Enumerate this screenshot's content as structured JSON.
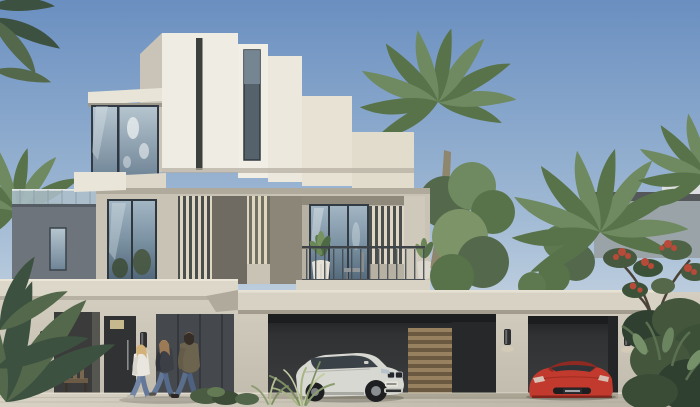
{
  "meta": {
    "domain": "architectural-exterior-render",
    "description": "Daytime render of a three-storey contemporary cream villa built of stacked cubic volumes with corner glass windows, timber louvre screens and a wide two-bay carport. A white luxury SUV and a red sports coupe sit in the carport, three residents stroll along the front pavement, and date palms with tropical planting frame the scene under a clear blue sky.",
    "time_of_day": "day",
    "weather": "clear"
  },
  "palette": {
    "sky_top": "#6a8fc0",
    "sky_mid": "#9db7d3",
    "sky_horizon": "#cdd9e4",
    "sky_base": "#d8dee3",
    "wall_white": "#efece3",
    "wall_white_shade": "#c9c4b7",
    "wall_cream": "#e2dccd",
    "wall_beige": "#cfc9bb",
    "wall_second_floor": "#c9c3b5",
    "wall_dark_wing": "#6e747b",
    "fascia": "#ddd7c9",
    "fascia_garage": "#d8d2c4",
    "soffit_shadow": "#a59f92",
    "glass_light": "#a3b6c4",
    "glass_dark": "#4e6476",
    "frame_dark": "#323b43",
    "opening_dark": "#303234",
    "passage_gray": "#45484c",
    "louver_cream": "#ded6c2",
    "louver_back": "#4a4e4c",
    "wood_light": "#97815e",
    "wood_dark": "#6b5840",
    "pavement_light": "#d8d2c4",
    "pavement_dark": "#b7b1a4",
    "trunk": "#8f866e",
    "palm_green": "#6f8a60",
    "palm_green_dark": "#587349",
    "foliage_dark": "#3c5038",
    "foliage_mid": "#53694b",
    "foliage_light": "#7d9469",
    "grass_light": "#a8b584",
    "flower_red": "#b84a3a",
    "distant_house": "#9aa3a8",
    "distant_roof": "#54585b",
    "lamp_dark": "#2e2f31",
    "suv_body": "#d8d8d2",
    "suv_glass": "#3a4147",
    "car_red": "#c23a2e",
    "skin": "#c49a68",
    "hair_blonde": "#d2b279",
    "hair_brown": "#9c7a55",
    "hair_dark": "#362e26",
    "top_white": "#e9e6df",
    "jacket_dark": "#3d3f46",
    "jacket_olive": "#6d6450",
    "jeans": "#64789a"
  },
  "scene": {
    "sky": {
      "type": "clear vertical gradient"
    },
    "buildings": [
      {
        "id": "main-villa",
        "storeys": 3,
        "style": "modern cubic",
        "materials": [
          "cream render",
          "glass",
          "timber louvres"
        ]
      },
      {
        "id": "neighbour-house",
        "position": "background right"
      }
    ],
    "vegetation": [
      {
        "id": "palm-center-tall"
      },
      {
        "id": "palm-right-large"
      },
      {
        "id": "palm-corner-top-right"
      },
      {
        "id": "palm-left-mid"
      },
      {
        "id": "green-tree-center"
      },
      {
        "id": "flowering-tree-red"
      },
      {
        "id": "tropical-bushes-right"
      },
      {
        "id": "foreground-fronds-bottom-left"
      },
      {
        "id": "corner-fronds-top-left"
      },
      {
        "id": "grass-tuft-driveway"
      },
      {
        "id": "balcony-potted-plants",
        "count": 2
      }
    ],
    "people": [
      {
        "id": "woman-blonde",
        "clothing": "white top, blue jeans",
        "hair": "blonde"
      },
      {
        "id": "woman-dark-jacket",
        "clothing": "dark jacket, blue jeans",
        "hair": "light brown"
      },
      {
        "id": "man-olive-jacket",
        "clothing": "olive jacket, blue jeans",
        "hair": "dark, beard"
      }
    ],
    "vehicles": [
      {
        "id": "white-suv",
        "type": "luxury SUV",
        "color_name": "white-silver",
        "location": "carport bay 1"
      },
      {
        "id": "red-sports-car",
        "type": "sports coupe",
        "color_name": "red",
        "location": "carport bay 2"
      }
    ],
    "fixtures": {
      "wall_sconces": 4,
      "balcony_chair": 1,
      "porch_chair": 1,
      "door_plaque": 1
    }
  }
}
